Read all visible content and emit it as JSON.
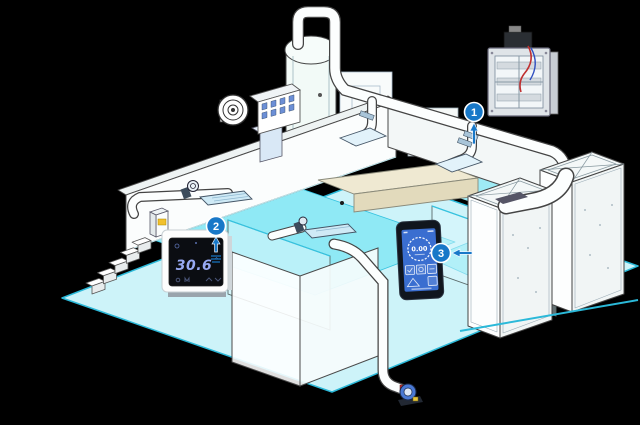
{
  "canvas": {
    "width": 640,
    "height": 425,
    "background_color": "#000000"
  },
  "colors": {
    "callout_blue": "#1878c8",
    "water_apron": "#cdf3f9",
    "water_pool": "#8fe9f5",
    "water_edge": "#2bb9d9",
    "wall_white": "#fbfdfd",
    "outline_gray": "#4a4a4a",
    "thermostat_digits": "#97a9f2",
    "controller_screen": "#3a6ed0",
    "diffuser_blue": "#cfeaf6",
    "wire_red": "#c03030",
    "wire_blue": "#3050c0"
  },
  "devices": {
    "thermostat": {
      "temperature": "30.6",
      "degree_symbol": "°"
    },
    "controller": {
      "reading": "0.00"
    }
  },
  "callouts": [
    {
      "number": "1"
    },
    {
      "number": "2"
    },
    {
      "number": "3"
    }
  ],
  "icons": {
    "callout_1_arrow": "up-arrow",
    "callout_2_arrow": "up-arrow",
    "callout_2_marker": "vent-lines",
    "callout_3_arrow": "left-arrow"
  }
}
